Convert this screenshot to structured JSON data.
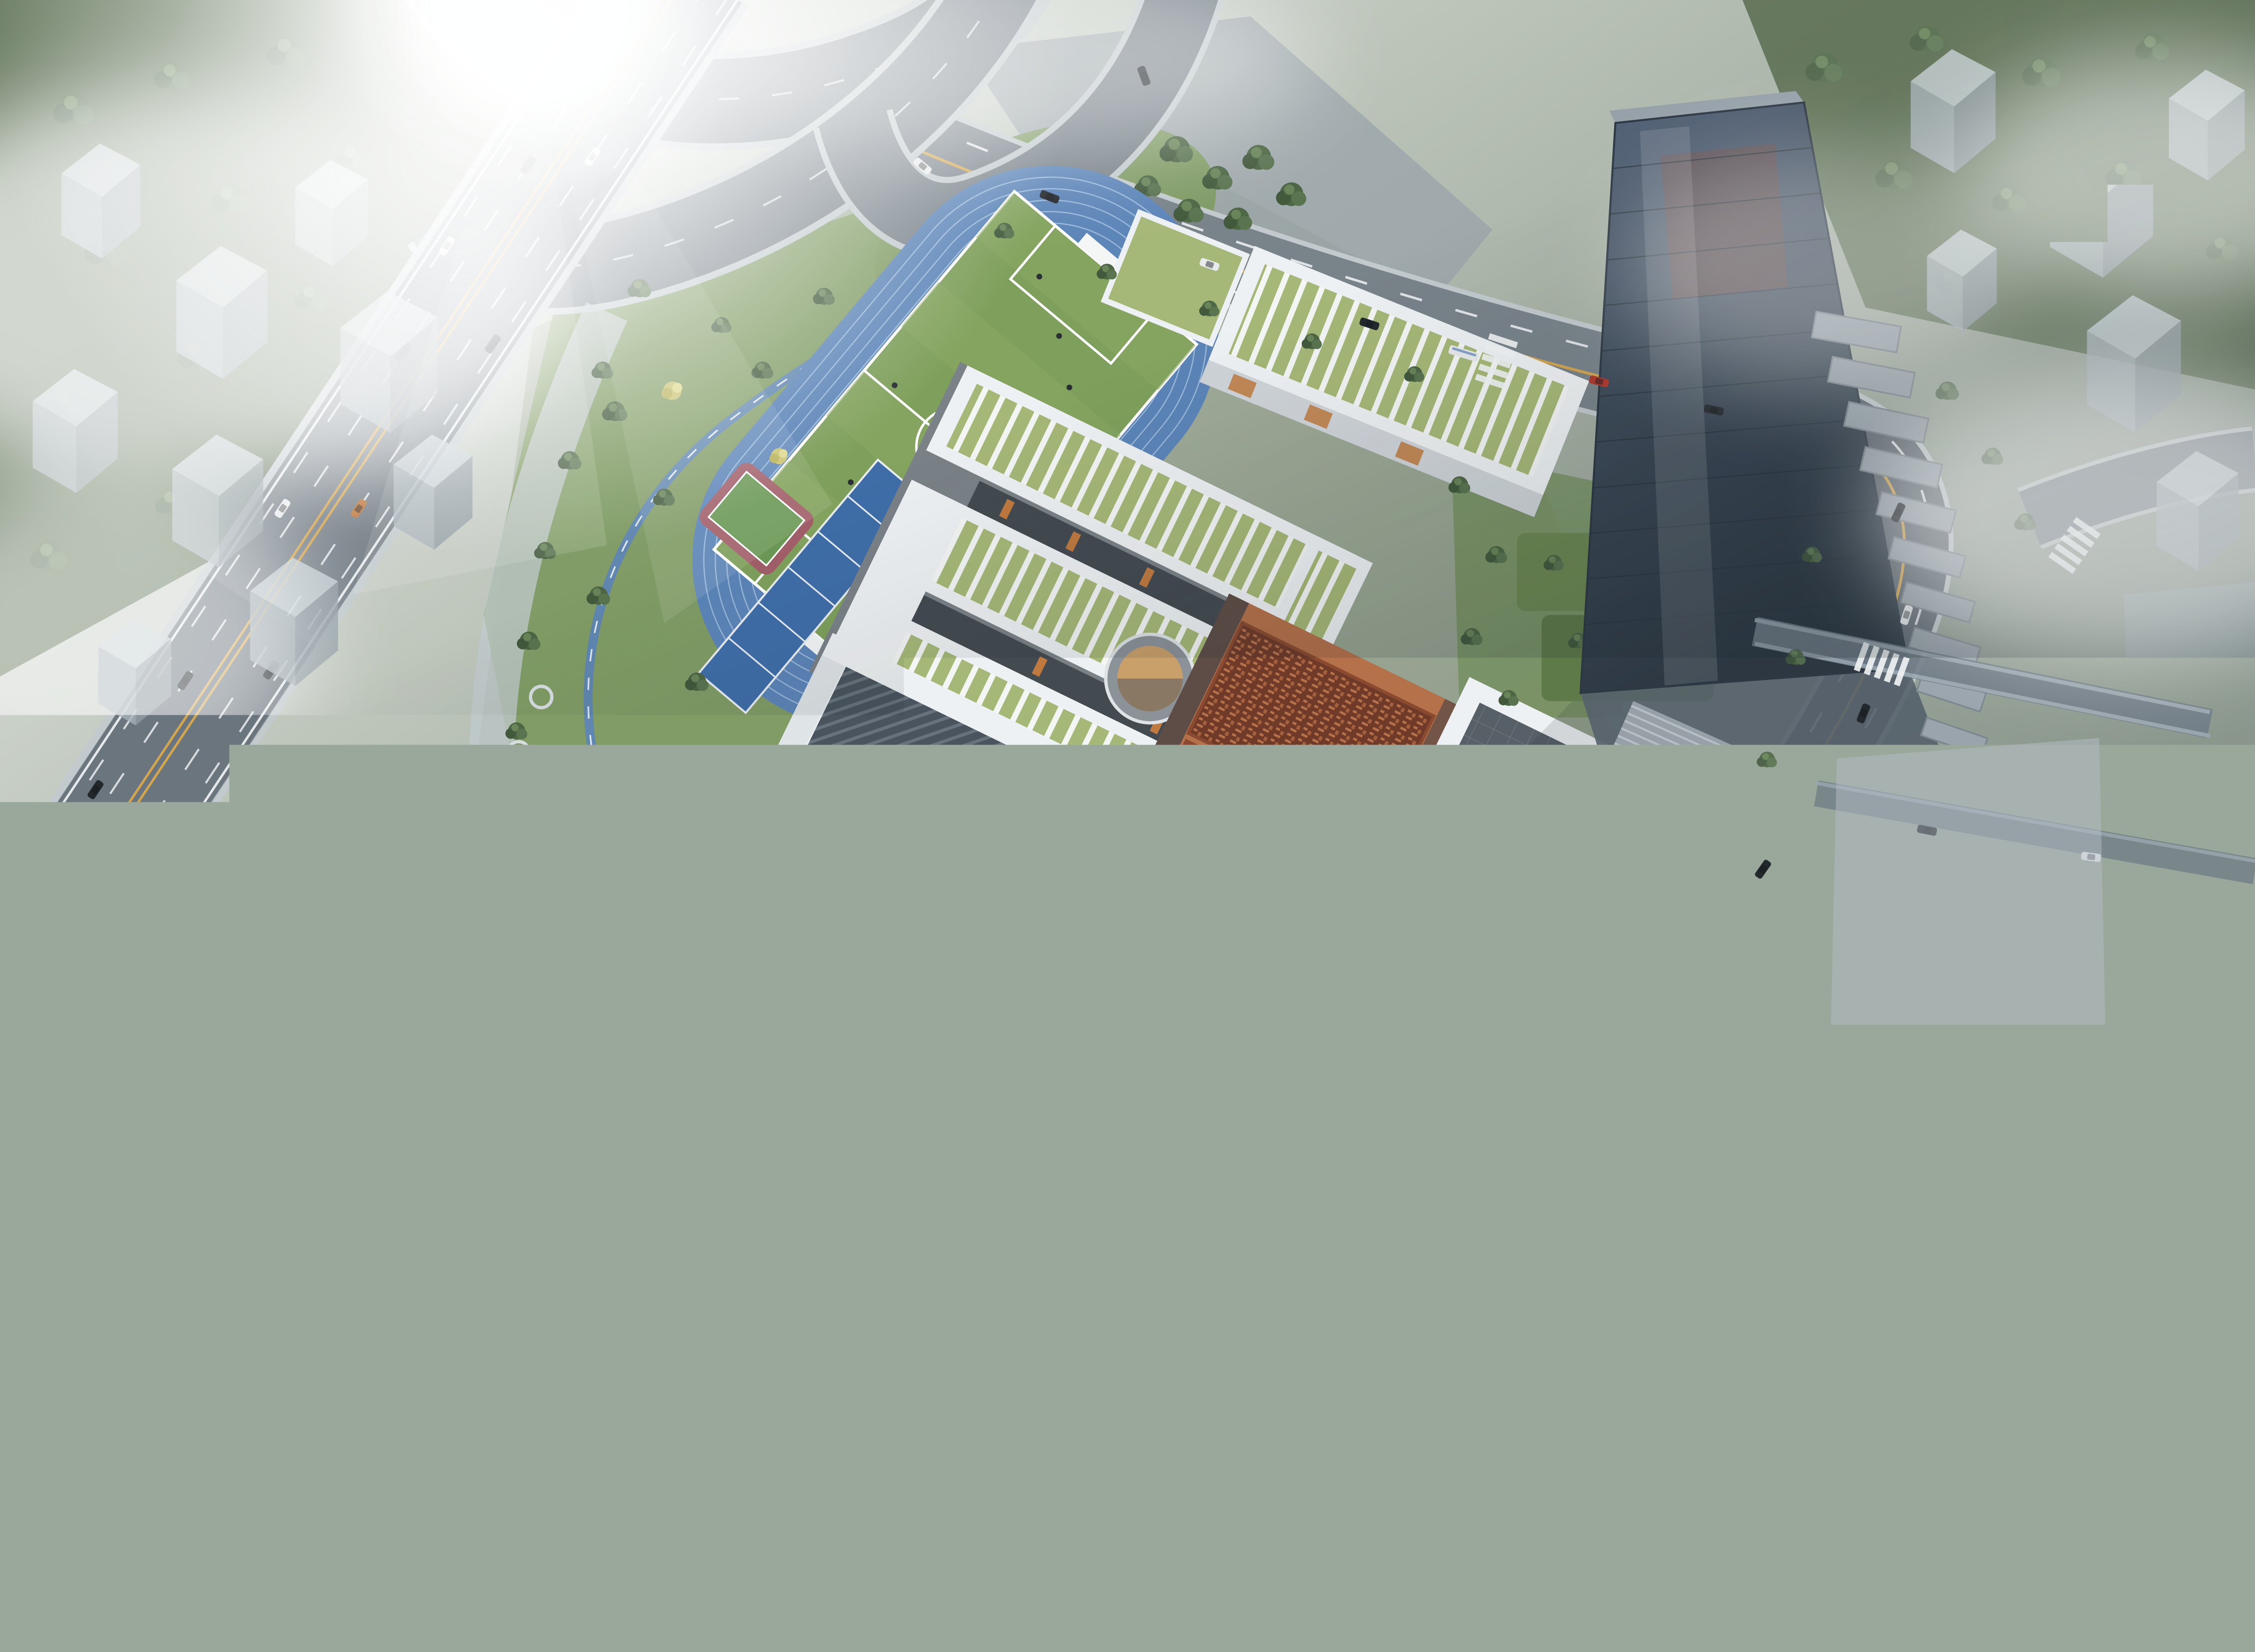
{
  "scene": {
    "title": "Aerial bird's-eye architectural rendering of a school campus at dawn",
    "view": "aerial three-quarter bird's-eye",
    "atmosphere": "strong sun glare in the upper-left, morning fog over the surrounding city blocks, translucent massing volumes at the edges",
    "landmarks": [
      {
        "id": "elevated-highway",
        "label": "elevated highway running diagonally on the left"
      },
      {
        "id": "interchange-ramps",
        "label": "curved interchange ramps at the top"
      },
      {
        "id": "running-track",
        "label": "blue 400m running track with green soccer field"
      },
      {
        "id": "court-strip",
        "label": "row of blue volleyball and tennis courts"
      },
      {
        "id": "basketball-courts",
        "label": "cluster of four basketball courts"
      },
      {
        "id": "park-court",
        "label": "small half court with red apron in the west park"
      },
      {
        "id": "tennis-court-park",
        "label": "tennis court on red oval pad near the highway"
      },
      {
        "id": "jogging-loop",
        "label": "blue jogging and cycling loop through the park"
      },
      {
        "id": "classroom-complex",
        "label": "white courtyard classroom buildings with green striped roofs"
      },
      {
        "id": "north-classroom-building",
        "label": "north classroom bar building along the arterial road"
      },
      {
        "id": "sunken-courtyard",
        "label": "circular sunken courtyard"
      },
      {
        "id": "auditorium-building",
        "label": "white auditorium with dark folded-plate roof"
      },
      {
        "id": "library-building",
        "label": "copper-clad building with ornamental lattice roof and red seal emblem"
      },
      {
        "id": "gymnasium-building",
        "label": "white hall with flat dark roof"
      },
      {
        "id": "central-plaza",
        "label": "paved entry plaza with planting bands and ginkgo trees"
      },
      {
        "id": "entrance-gate",
        "label": "campus entrance gate"
      },
      {
        "id": "pavilion-pond",
        "label": "small pavilion with blue pond"
      },
      {
        "id": "office-tower",
        "label": "dark glass office tower with cascading terraces"
      },
      {
        "id": "kindergarten-building",
        "label": "X-shaped kindergarten with green roof wings and skylights"
      },
      {
        "id": "south-forest",
        "label": "dense dark forest in the foreground"
      },
      {
        "id": "fog-banks",
        "label": "fog banks over surrounding city"
      },
      {
        "id": "massing-blocks",
        "label": "translucent grey massing blocks of neighbouring city"
      }
    ]
  },
  "palette": {
    "sky_fog": "#dfe5e6",
    "asphalt": "#79838a",
    "asphalt_dark": "#4a545c",
    "road_line_white": "#f2f5f6",
    "road_line_yellow": "#d2a54f",
    "sidewalk": "#c2cacd",
    "track_blue": "#5c85b8",
    "track_lane": "#a9c4e0",
    "field_green": "#7fa05c",
    "court_green": "#6d9a58",
    "court_blue": "#3f6ea8",
    "court_red": "#a2606a",
    "lawn": "#7d9a5f",
    "park_green": "#6b8a52",
    "forest": "#31412f",
    "forest_light": "#54684a",
    "tree_green": "#4d6644",
    "tree_yellow": "#c9c26e",
    "roof_white": "#eef1f3",
    "roof_green": "#a6b877",
    "facade_grey": "#c3cacf",
    "window_dark": "#3a4147",
    "accent_orange": "#c07a3f",
    "auditorium_roof": "#49545e",
    "copper": "#b5714a",
    "copper_dark": "#6f3a28",
    "seal_red": "#a33326",
    "hall_roof": "#575f67",
    "tower_glass": "#3d4a58",
    "tower_frame": "#97a1a9",
    "podium_green": "#6c8752",
    "plaza": "#b6bec5",
    "plaza_stripe": "#c9d0d5",
    "pond_blue": "#5b88ad",
    "massing": "#b3bec5",
    "kinder_green": "#9fb573",
    "skylight": "#a9c2da",
    "wood": "#b5854e",
    "car_dark": "#23282d",
    "car_white": "#e8eaec",
    "car_red": "#b03a30",
    "people": "#2a2f33",
    "fog": "#ffffff"
  }
}
